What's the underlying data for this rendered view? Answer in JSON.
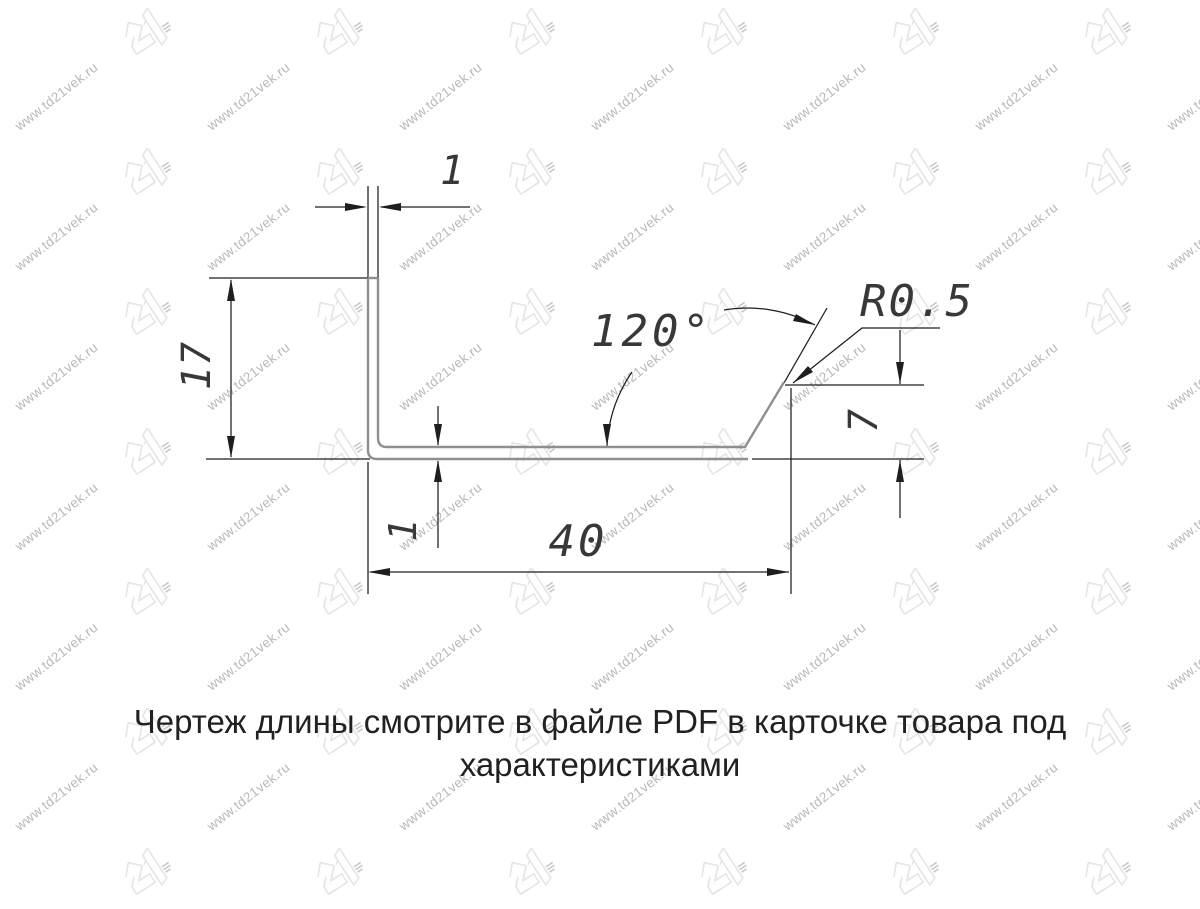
{
  "watermark": {
    "text": "www.td21vek.ru",
    "logo_text": "21",
    "text_color": "#b8b8b8",
    "logo_color": "#e5e5e5",
    "logo_mark_color": "#c9c9c9"
  },
  "drawing": {
    "labels": {
      "wall_thickness": "1",
      "height": "17",
      "bend_angle": "120°",
      "bend_radius": "R0.5",
      "lip_height": "7",
      "width": "40",
      "base_thickness": "1"
    },
    "colors": {
      "profile": "#8f8f8f",
      "dimension": "#1e1e1e"
    }
  },
  "caption": {
    "line1": "Чертеж длины смотрите в файле PDF в карточке товара под",
    "line2": "характеристиками"
  }
}
